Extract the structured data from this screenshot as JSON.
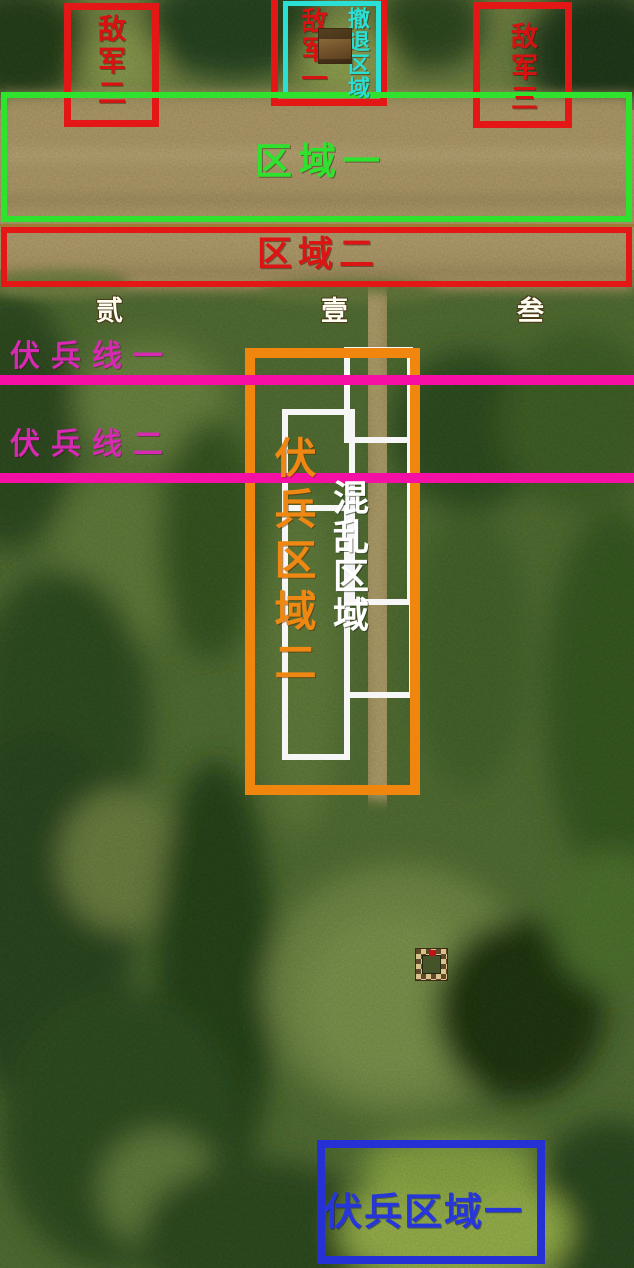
{
  "map": {
    "enemy_boxes": [
      {
        "id": "enemy-army-2",
        "label": "敌军二",
        "color": "#e41717"
      },
      {
        "id": "enemy-army-1",
        "label": "敌军一",
        "color": "#e41717"
      },
      {
        "id": "enemy-army-3",
        "label": "敌军三",
        "color": "#e41717"
      }
    ],
    "retreat_zone": {
      "label": "撤退区域",
      "color": "#2adfd5"
    },
    "area_zones": [
      {
        "id": "area-1",
        "label": "区域一",
        "color": "#2ee22e"
      },
      {
        "id": "area-2",
        "label": "区域二",
        "color": "#e41717"
      }
    ],
    "waypoints": [
      {
        "label": "贰"
      },
      {
        "label": "壹"
      },
      {
        "label": "叁"
      }
    ],
    "ambush_lines": [
      {
        "id": "ambush-line-1",
        "label": "伏兵线一",
        "color": "#f50fa5"
      },
      {
        "id": "ambush-line-2",
        "label": "伏兵线二",
        "color": "#f50fa5"
      }
    ],
    "ambush_areas": [
      {
        "id": "ambush-area-2",
        "label": "伏兵区域二",
        "color": "#f1860f"
      },
      {
        "id": "ambush-area-1",
        "label": "伏兵区域一",
        "color": "#2531d4"
      }
    ],
    "chaos_zone": {
      "label": "混乱区域",
      "color": "#ffffff"
    },
    "icons": [
      {
        "id": "hut-icon"
      },
      {
        "id": "fort-icon"
      }
    ]
  }
}
